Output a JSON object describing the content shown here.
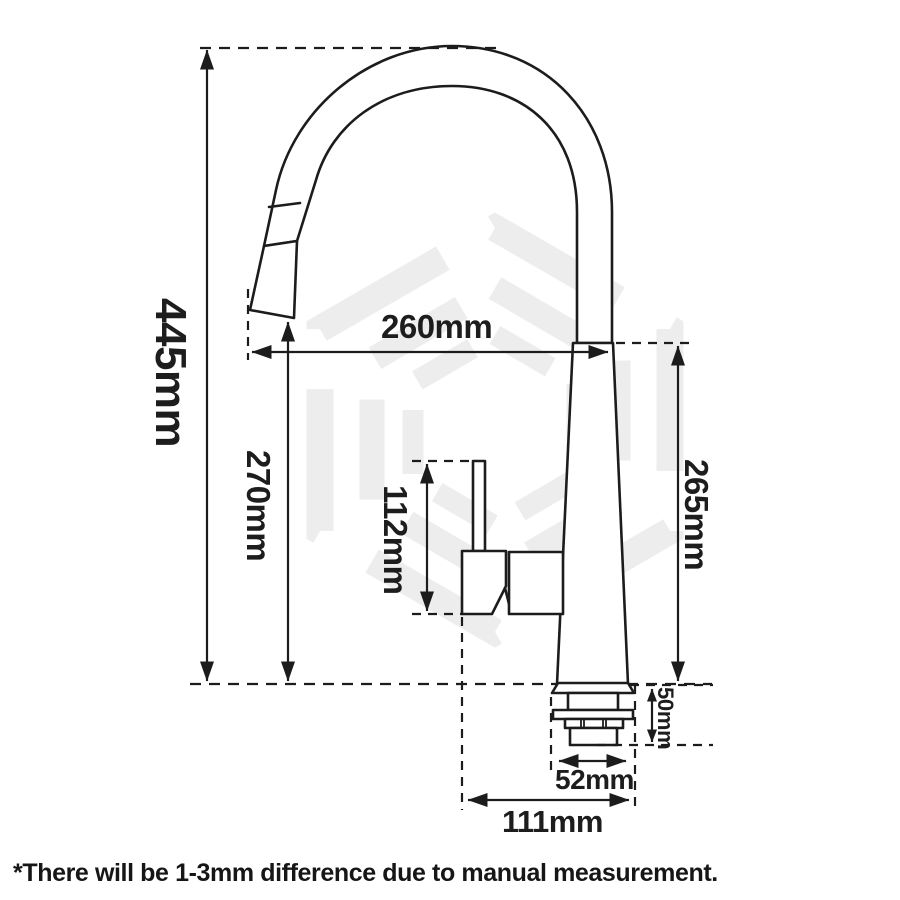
{
  "diagram": {
    "type": "technical dimension drawing",
    "product": "pull-out gooseneck kitchen mixer tap",
    "dimensions": {
      "total_height": {
        "label": "445mm",
        "meaning": "overall height from base line to top of spout arch"
      },
      "spout_reach": {
        "label": "260mm",
        "meaning": "horizontal reach from spout outlet to body"
      },
      "outlet_clearance": {
        "label": "270mm",
        "meaning": "height from base line to spout outlet"
      },
      "handle_height": {
        "label": "112mm",
        "meaning": "height of side lever handle assembly"
      },
      "body_height": {
        "label": "265mm",
        "meaning": "height of tap body column above base line"
      },
      "shank_depth": {
        "label": "50mm",
        "meaning": "under-bench shank depth below base flange"
      },
      "shank_width": {
        "label": "52mm",
        "meaning": "width across mounting shank hardware"
      },
      "base_span": {
        "label": "111mm",
        "meaning": "span from handle edge to base edge"
      }
    },
    "footnote": "*There will be 1-3mm difference due to manual measurement."
  },
  "icons": {
    "watermark": "hexagon-logo-watermark"
  },
  "colors": {
    "background": "#ffffff",
    "line_art": "#1c1c1c",
    "watermark": "#ededed"
  }
}
